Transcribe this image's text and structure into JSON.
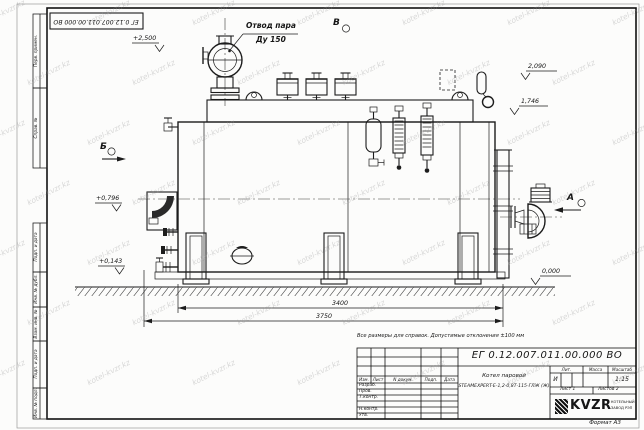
{
  "sheet": {
    "format_label": "Формат А3",
    "watermark_text": "kotel-kvzr.kz",
    "top_stamp_number": "ЕГ 0.12.007.011.00.000  ВО",
    "margin_labels": {
      "perv_primen": "Перв. примен.",
      "sprav_no": "Справ. №",
      "podp_data_1": "Подп. и дата",
      "inv_dubl": "Инв. № дубл.",
      "vzam_inv": "Взам. инв. №",
      "podp_data_2": "Подп. и дата",
      "inv_podl": "Инв. № подл."
    }
  },
  "drawing": {
    "callouts": {
      "steam_outlet_line1": "Отвод пара",
      "steam_outlet_line2": "Ду 150",
      "view_top": "В",
      "view_left": "Б",
      "view_right": "А"
    },
    "levels": {
      "platform": "+2,500",
      "drum_top": "2,090",
      "shell_top": "1,746",
      "burner_axis": "+0,796",
      "base": "+0,143",
      "ground": "0,000"
    },
    "dimensions": {
      "inner_length": "3400",
      "overall_length": "3750"
    },
    "note": "Все размеры для справок. Допустимые отклонения ±100 мм"
  },
  "title_block": {
    "doc_number": "ЕГ 0.12.007.011.00.000  ВО",
    "product_name_line1": "Котел паровой",
    "product_name_line2": "STEAMEXPERT-Е-1,2-0,8Т-115-ГЛЖ (Ж)",
    "columns": {
      "izm": "Изм.",
      "list": "Лист",
      "doc": "N докум.",
      "podp": "Подп.",
      "data": "Дата"
    },
    "rows": {
      "razrab": "Разраб.",
      "prov": "Пров.",
      "tkontr": "Т.контр.",
      "nkontr": "Н.контр.",
      "utv": "Утв."
    },
    "lit_header": "Лит.",
    "mass_header": "Масса",
    "scale_header": "Масштаб",
    "lit_value": "И",
    "scale_value": "1:15",
    "sheet_label": "Лист",
    "sheet_value": "1",
    "sheets_label": "Листов",
    "sheets_value": "2",
    "company": {
      "logo": "KVZR",
      "org_line1": "КОТЕЛЬНЫЙ",
      "org_line2": "ЗАВОД РЭП"
    }
  }
}
